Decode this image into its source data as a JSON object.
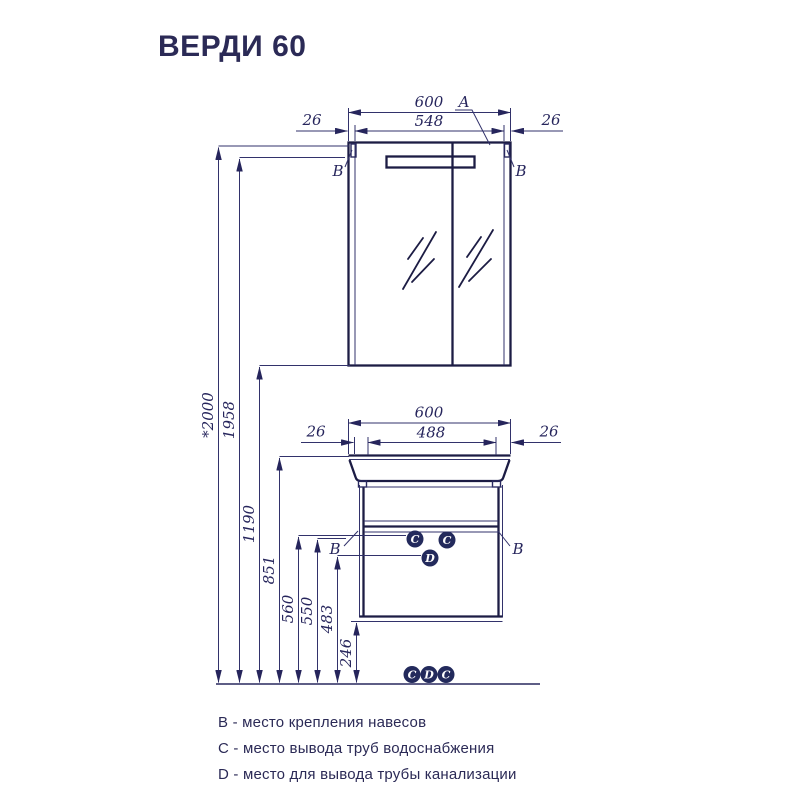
{
  "title": "ВЕРДИ 60",
  "drawing": {
    "mirror_unit": {
      "width_total": "600",
      "width_inner": "548",
      "offset_left": "26",
      "offset_right": "26",
      "marker_a": "A",
      "marker_b_left": "B",
      "marker_b_right": "B"
    },
    "vanity_unit": {
      "width_total": "600",
      "width_inner": "488",
      "offset_left": "26",
      "offset_right": "26",
      "marker_b_left": "B",
      "marker_b_right": "B",
      "marker_c_left": "C",
      "marker_c_right": "C",
      "marker_d": "D"
    },
    "heights": {
      "overall": "*2000",
      "mirror_top": "1958",
      "mirror_bottom": "1190",
      "basin_top": "851",
      "water_supply": "560",
      "hanger": "550",
      "drain": "483",
      "cabinet_bottom": "246"
    },
    "floor_markers": {
      "c_left": "C",
      "d": "D",
      "c_right": "C"
    }
  },
  "legend": {
    "items": [
      {
        "text": "B - место крепления навесов"
      },
      {
        "text": "C - место вывода труб водоснабжения"
      },
      {
        "text": "D - место для вывода трубы канализации"
      }
    ]
  },
  "colors": {
    "line": "#29295f",
    "heavy_line": "#1c1c44",
    "text": "#2b2a56",
    "marker_fill": "#232a5c"
  }
}
